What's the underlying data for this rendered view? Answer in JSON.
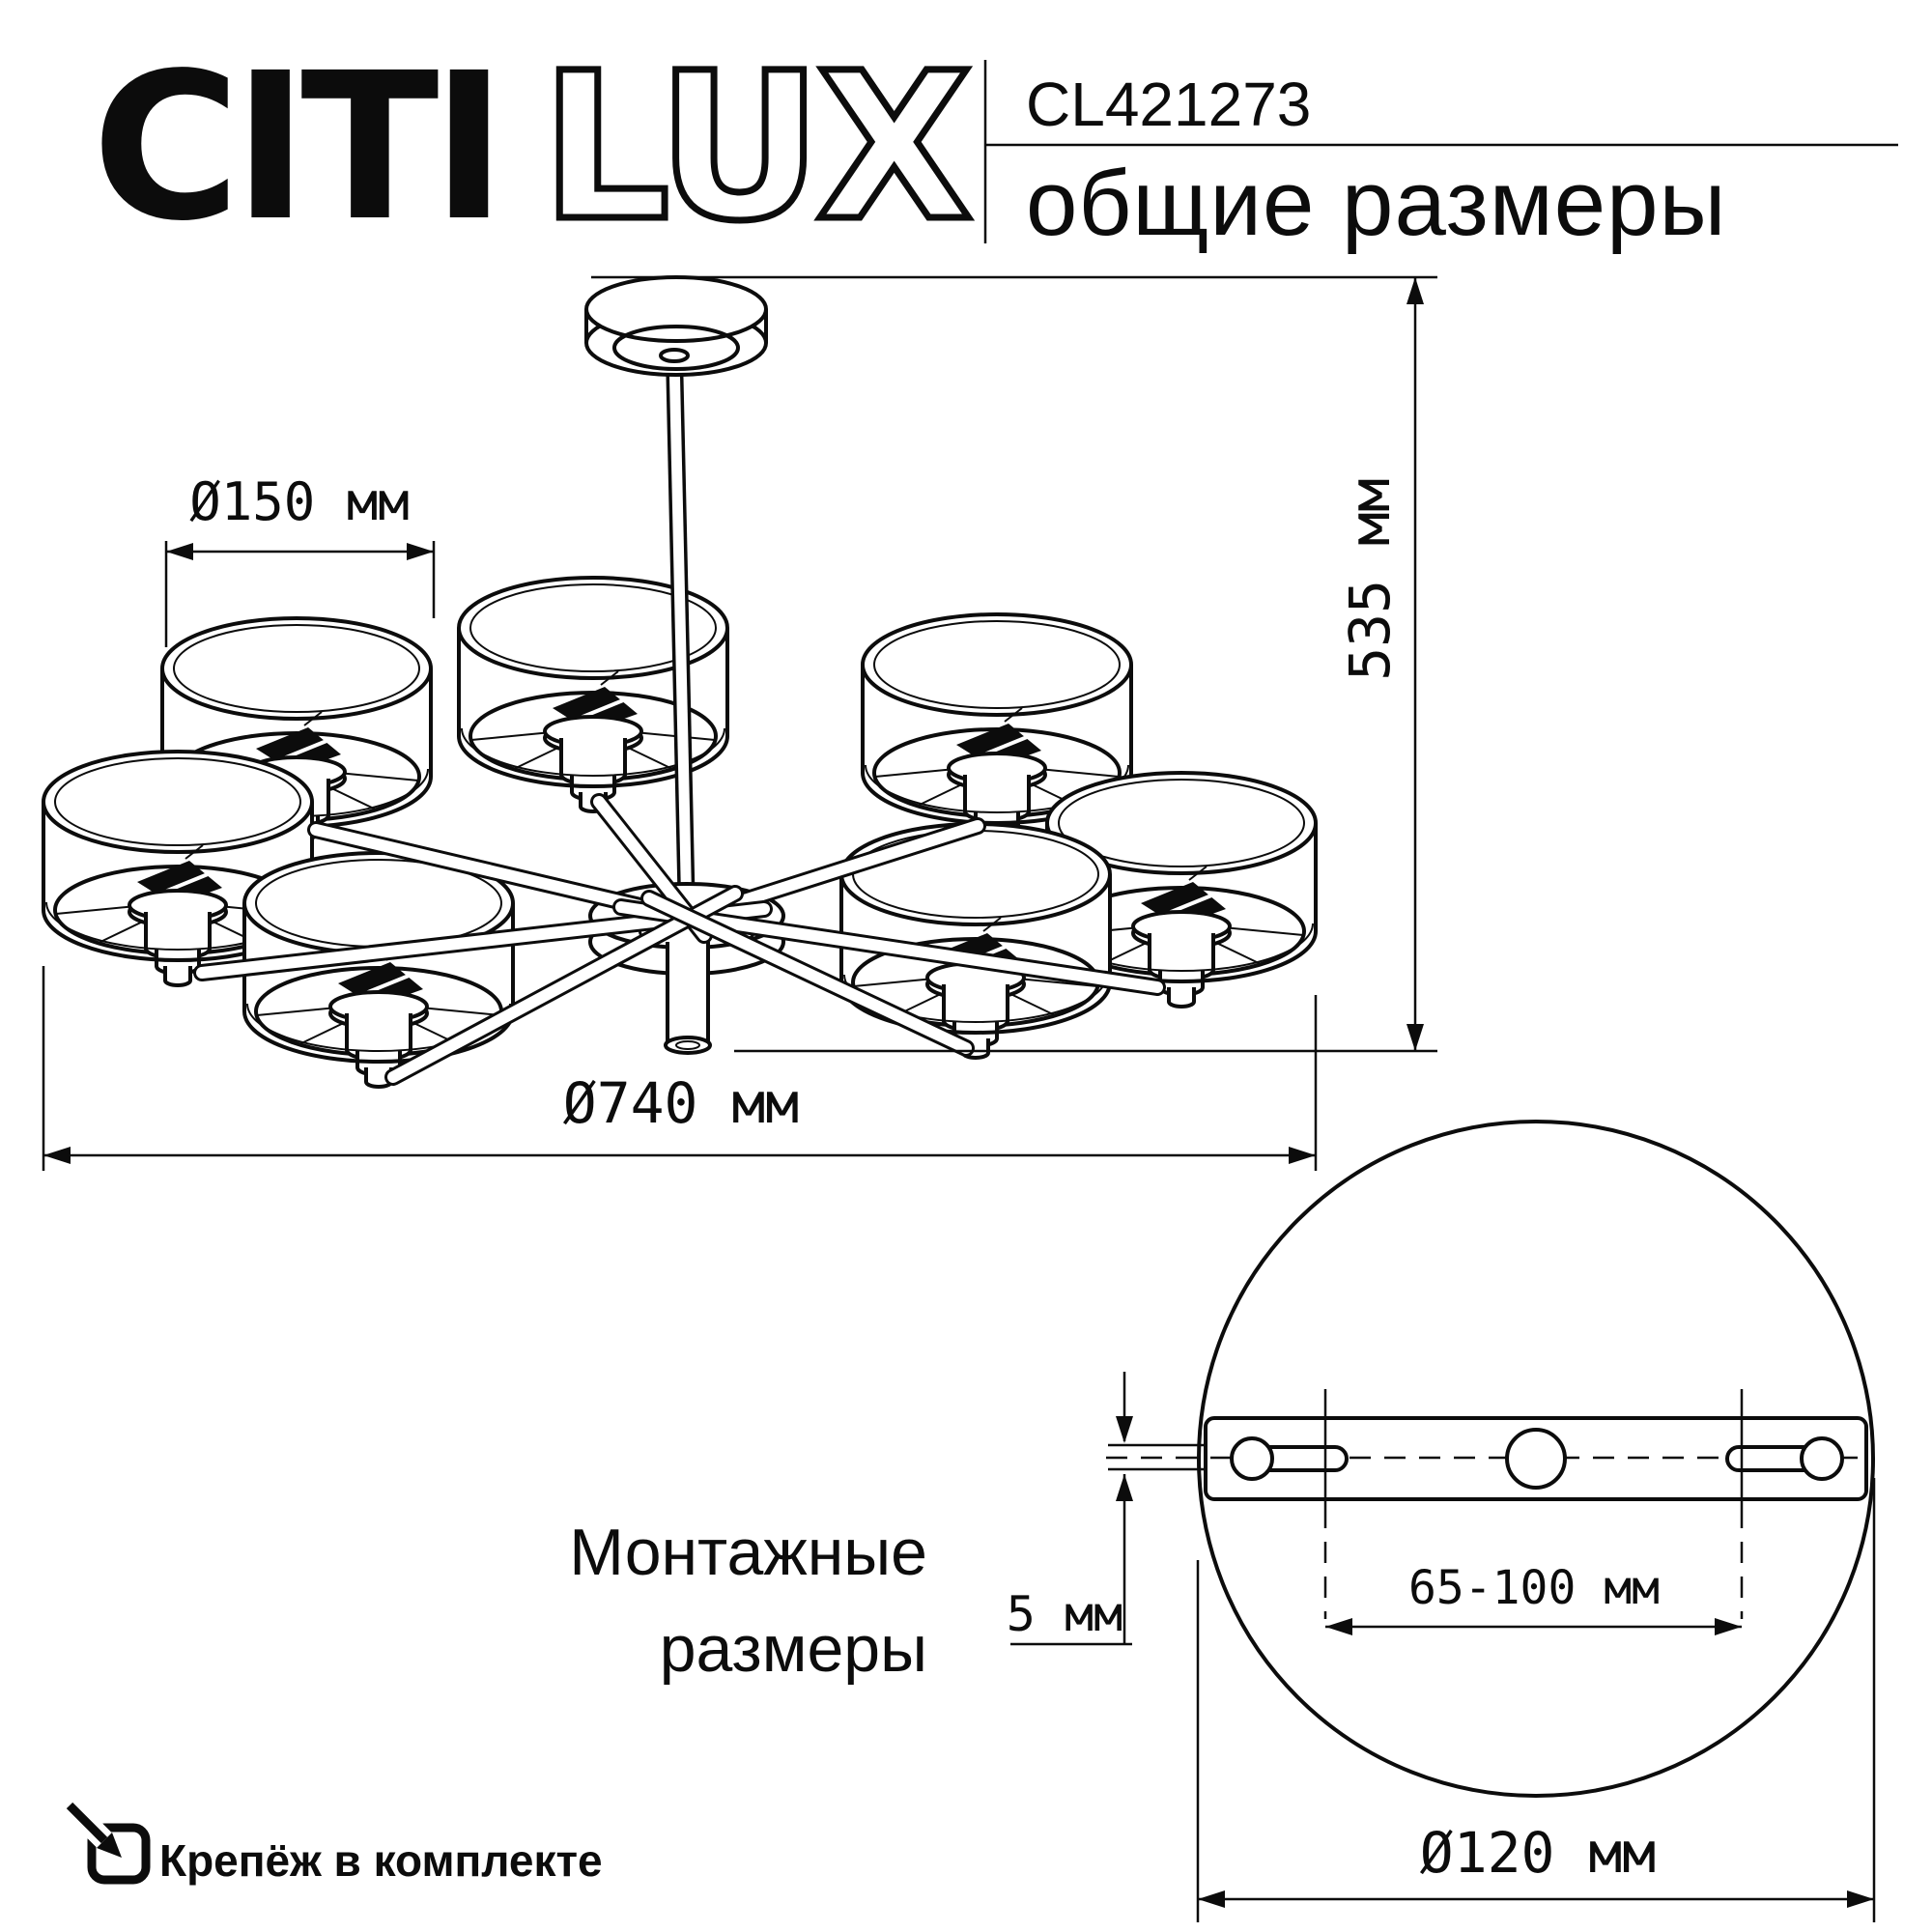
{
  "header": {
    "brand_citi": "CITI",
    "brand_lux": "LUX",
    "model": "CL421273",
    "subtitle": "общие размеры"
  },
  "general_drawing": {
    "shade_diameter_label": "Ø150 мм",
    "height_label": "535 мм",
    "overall_diameter_label": "Ø740 мм"
  },
  "mounting_drawing": {
    "title_line1": "Монтажные",
    "title_line2": "размеры",
    "screw_span_label": "65-100 мм",
    "plate_thickness_label": "5 мм",
    "plate_diameter_label": "Ø120 мм"
  },
  "footer": {
    "note": "Крепёж в комплекте"
  },
  "colors": {
    "ink": "#0c0c0c",
    "paper": "#ffffff"
  }
}
